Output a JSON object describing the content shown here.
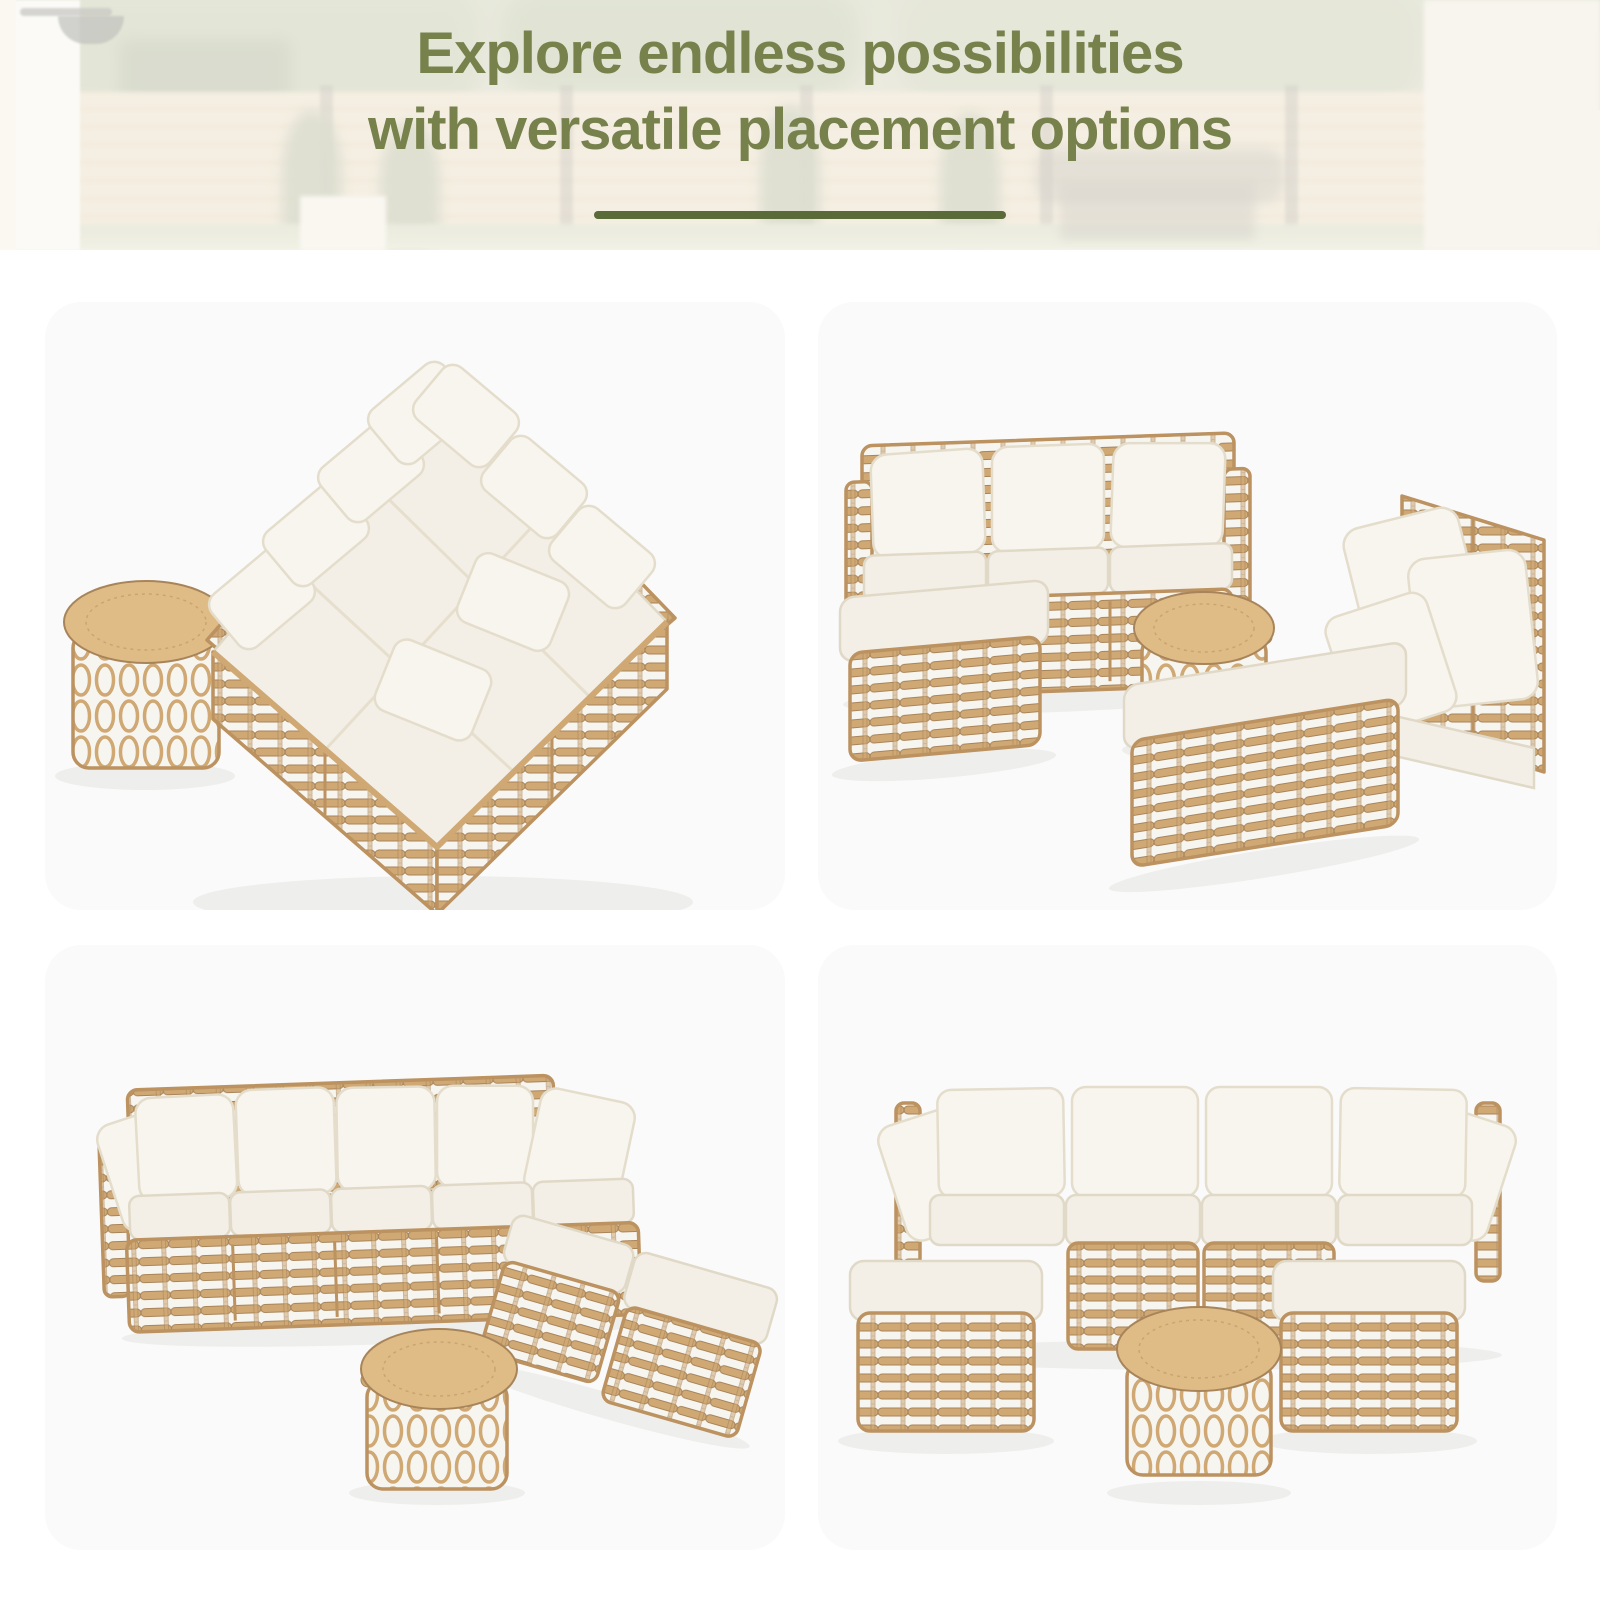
{
  "hero": {
    "title_line1": "Explore endless possibilities",
    "title_line2": "with versatile placement options"
  },
  "theme": {
    "accent_green": "#76814c",
    "underline_green": "#5a6a38",
    "page_bg": "#ffffff",
    "panel_bg": "#fafafa",
    "wicker": "#cfa873",
    "wicker_dark": "#a8845a",
    "wicker_frame": "#bb9260",
    "weave_gap": "#f7f5f0",
    "cushion": "#f3efe6",
    "cushion_edge": "#e0d9c7",
    "pillow": "#f8f5ee",
    "pillow_edge": "#e4ddcb",
    "table_top": "#dfbc86"
  },
  "panels": [
    {
      "id": "daybed",
      "description": "Six modules joined into a large daybed with pillows and a round wicker side table"
    },
    {
      "id": "sofa-chaise",
      "description": "Three-seat sofa with bench ottoman, round table and a double chaise of two chairs with ottoman"
    },
    {
      "id": "l-sectional",
      "description": "L-shaped sectional sofa with forward wing, ottoman and round coffee table"
    },
    {
      "id": "u-sectional",
      "description": "Four-seat sofa with an ottoman at each end and a round coffee table in front"
    }
  ]
}
